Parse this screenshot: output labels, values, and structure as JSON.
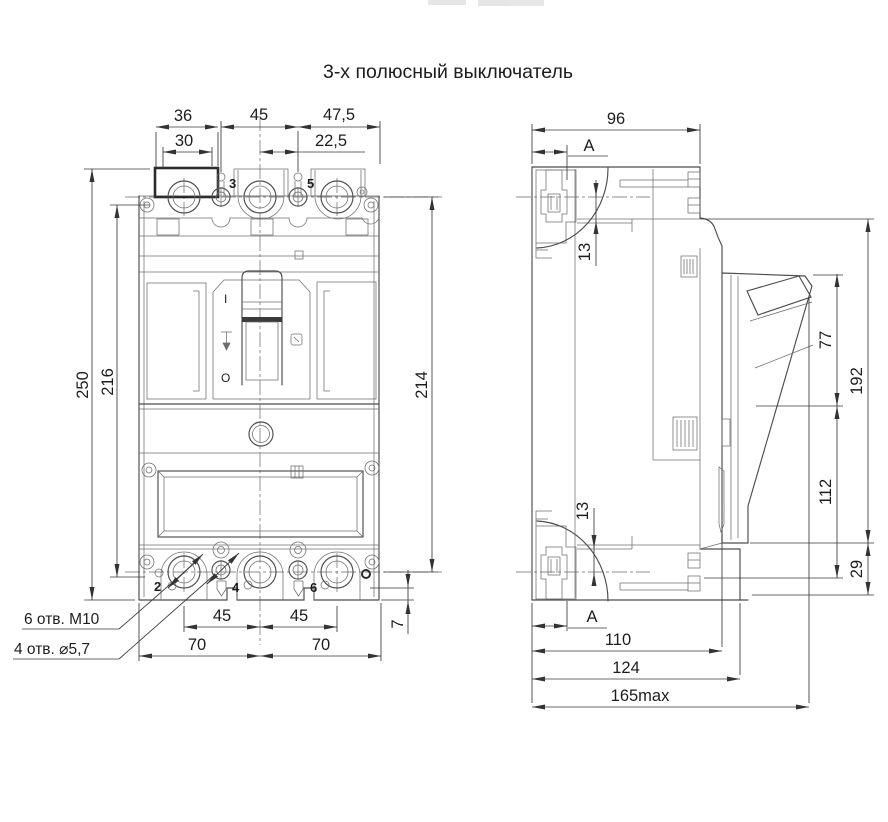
{
  "colors": {
    "background": "#ffffff",
    "line": "#4d4d4d",
    "text": "#1d1d1d"
  },
  "title": "3-х полюсный выключатель",
  "front": {
    "dim_36": "36",
    "dim_30": "30",
    "dim_45": "45",
    "dim_47_5": "47,5",
    "dim_22_5": "22,5",
    "dim_250": "250",
    "dim_216": "216",
    "dim_214": "214",
    "dim_45_bottom_left": "45",
    "dim_45_bottom_right": "45",
    "dim_70_left": "70",
    "dim_70_right": "70",
    "dim_7": "7",
    "pole_3": "3",
    "pole_5": "5",
    "pole_2": "2",
    "pole_4": "4",
    "pole_6": "6",
    "switch_on": "I",
    "switch_off": "O",
    "note_m10": "6 отв. М10",
    "note_d5_7": "4 отв. ⌀5,7"
  },
  "side": {
    "dim_96": "96",
    "dim_13_top": "13",
    "dim_13_bottom": "13",
    "dim_77": "77",
    "dim_192": "192",
    "dim_112": "112",
    "dim_29": "29",
    "dim_110": "110",
    "dim_124": "124",
    "dim_165": "165max",
    "section_a_top": "A",
    "section_a_bottom": "A"
  }
}
